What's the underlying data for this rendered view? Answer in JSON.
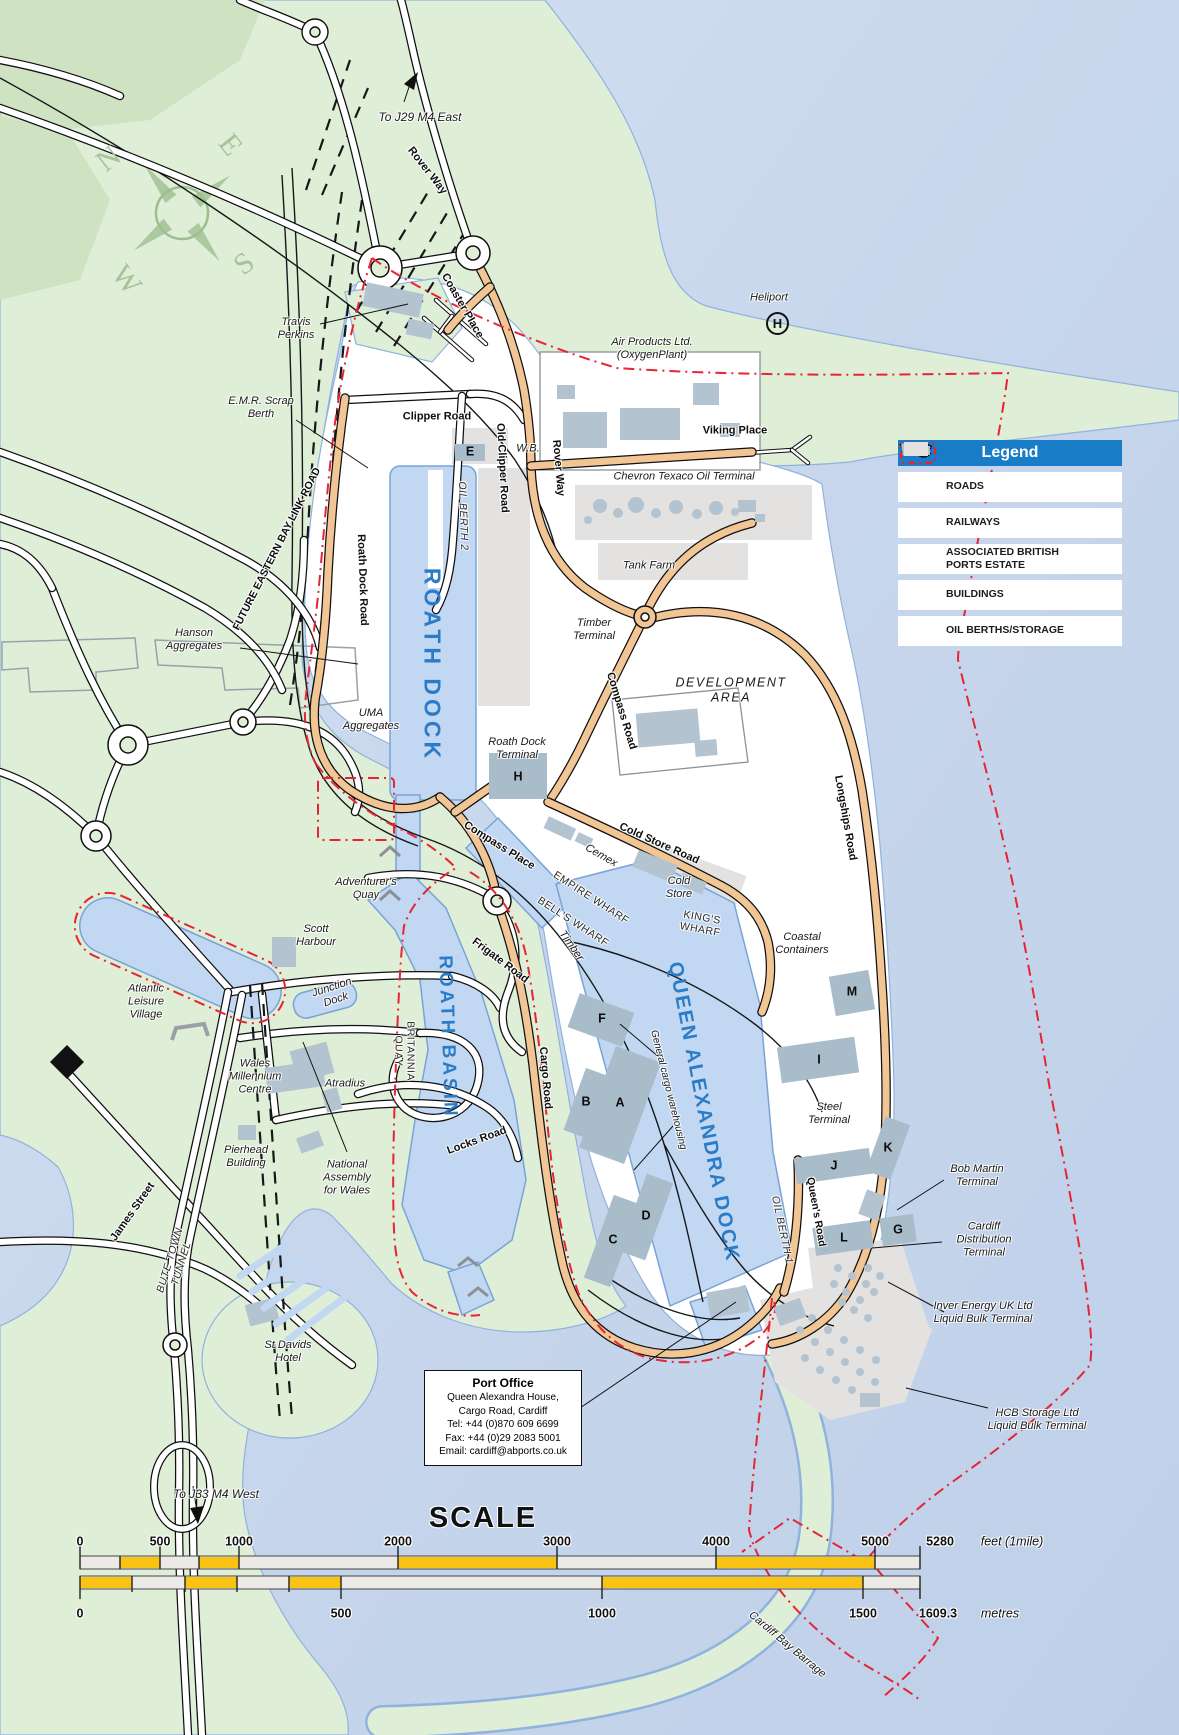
{
  "colors": {
    "water": "#c7d6ec",
    "water_light": "#d6e1f3",
    "land": "#dfeed6",
    "land_dark": "#cfe3c2",
    "port": "#ffffff",
    "dock_fill": "#c2d8f2",
    "dock_stroke": "#79a3d6",
    "road_orange": "#f2c694",
    "building": "#b3c3cf",
    "pad": "#a9bcca",
    "storage": "#e3e2e0",
    "boundary": "#e62433",
    "legend_blue": "#187dc6",
    "scale_yellow": "#f8c313",
    "dock_text": "#2a7cc9"
  },
  "legend": {
    "title": "Legend",
    "items": [
      {
        "label": "ROADS"
      },
      {
        "label": "RAILWAYS"
      },
      {
        "label": "ASSOCIATED BRITISH\nPORTS ESTATE"
      },
      {
        "label": "BUILDINGS"
      },
      {
        "label": "OIL BERTHS/STORAGE"
      }
    ]
  },
  "port_office": {
    "title": "Port Office",
    "lines": [
      "Queen Alexandra House,",
      "Cargo Road, Cardiff",
      "Tel: +44 (0)870 609 6699",
      "Fax: +44 (0)29 2083 5001",
      "Email: cardiff@abports.co.uk"
    ]
  },
  "compass": {
    "n": "N",
    "e": "E",
    "s": "S",
    "w": "W"
  },
  "heliport_symbol": "H",
  "scale": {
    "title": "SCALE",
    "feet": {
      "ticks": [
        "0",
        "500",
        "1000",
        "2000",
        "3000",
        "4000",
        "5000"
      ],
      "end": "5280",
      "unit": "feet (1mile)"
    },
    "metres": {
      "ticks": [
        "0",
        "500",
        "1000",
        "1500"
      ],
      "end": "1609.3",
      "unit": "metres"
    }
  },
  "labels": [
    {
      "t": "To J29 M4 East",
      "x": 420,
      "y": 117,
      "cls": "it",
      "s": 12
    },
    {
      "t": "Rover Way",
      "x": 427,
      "y": 171,
      "r": 52,
      "cls": "rd"
    },
    {
      "t": "Coaster Place",
      "x": 462,
      "y": 306,
      "r": 60,
      "cls": "rd"
    },
    {
      "t": "Travis\nPerkins",
      "x": 296,
      "y": 329,
      "cls": "it"
    },
    {
      "t": "Heliport",
      "x": 769,
      "y": 298,
      "cls": "it"
    },
    {
      "t": "Air Products Ltd.\n(OxygenPlant)",
      "x": 652,
      "y": 349,
      "cls": "it"
    },
    {
      "t": "Viking Place",
      "x": 735,
      "y": 431,
      "cls": "rd"
    },
    {
      "t": "Chevron Texaco Oil Terminal",
      "x": 684,
      "y": 477,
      "cls": "it"
    },
    {
      "t": "W.B.",
      "x": 528,
      "y": 449,
      "cls": "it"
    },
    {
      "t": "Clipper Road",
      "x": 437,
      "y": 417,
      "cls": "rd"
    },
    {
      "t": "Old Clipper Road",
      "x": 502,
      "y": 468,
      "r": 87,
      "cls": "rd"
    },
    {
      "t": "Rover Way",
      "x": 558,
      "y": 468,
      "r": 85,
      "cls": "rd"
    },
    {
      "t": "E.M.R. Scrap\nBerth",
      "x": 261,
      "y": 408,
      "cls": "it"
    },
    {
      "t": "FUTURE EASTERN BAY LINK ROAD",
      "x": 277,
      "y": 549,
      "r": -63,
      "cls": "rd",
      "s": 10.5
    },
    {
      "t": "Roath Dock Road",
      "x": 362,
      "y": 580,
      "r": 88,
      "cls": "rd"
    },
    {
      "t": "OIL BERTH 2",
      "x": 463,
      "y": 516,
      "r": 88,
      "cls": "capit"
    },
    {
      "t": "ROATH DOCK",
      "x": 432,
      "y": 665,
      "r": 90,
      "cls": "dk",
      "s": 23,
      "ls": 4
    },
    {
      "t": "Hanson\nAggregates",
      "x": 194,
      "y": 640,
      "cls": "it"
    },
    {
      "t": "UMA\nAggregates",
      "x": 371,
      "y": 720,
      "cls": "it"
    },
    {
      "t": "Tank Farm",
      "x": 649,
      "y": 566,
      "cls": "it"
    },
    {
      "t": "Timber\nTerminal",
      "x": 594,
      "y": 630,
      "cls": "it"
    },
    {
      "t": "Compass Road",
      "x": 621,
      "y": 711,
      "r": 73,
      "cls": "rd"
    },
    {
      "t": "DEVELOPMENT\nAREA",
      "x": 731,
      "y": 690,
      "cls": "it",
      "s": 12.5,
      "ls": 1.5
    },
    {
      "t": "Roath Dock\nTerminal",
      "x": 517,
      "y": 749,
      "cls": "it"
    },
    {
      "t": "Longships Road",
      "x": 845,
      "y": 818,
      "r": 80,
      "cls": "rd"
    },
    {
      "t": "Compass Place",
      "x": 499,
      "y": 846,
      "r": 32,
      "cls": "rd"
    },
    {
      "t": "Cold Store Road",
      "x": 659,
      "y": 844,
      "r": 24,
      "cls": "rd"
    },
    {
      "t": "Cemex",
      "x": 601,
      "y": 856,
      "r": 30,
      "cls": "it"
    },
    {
      "t": "Cold\nStore",
      "x": 679,
      "y": 888,
      "cls": "it"
    },
    {
      "t": "EMPIRE WHARF",
      "x": 591,
      "y": 898,
      "r": 33,
      "cls": "cap"
    },
    {
      "t": "BELL'S WHARF",
      "x": 573,
      "y": 922,
      "r": 33,
      "cls": "cap"
    },
    {
      "t": "KING'S\nWHARF",
      "x": 701,
      "y": 924,
      "r": 10,
      "cls": "cap"
    },
    {
      "t": "Coastal\nContainers",
      "x": 802,
      "y": 944,
      "cls": "it"
    },
    {
      "t": "Adventurer's\nQuay",
      "x": 366,
      "y": 889,
      "cls": "it"
    },
    {
      "t": "Scott\nHarbour",
      "x": 316,
      "y": 936,
      "cls": "it"
    },
    {
      "t": "Junction\nDock",
      "x": 334,
      "y": 994,
      "r": -18,
      "cls": "it"
    },
    {
      "t": "ROATH BASIN",
      "x": 447,
      "y": 1037,
      "r": 88,
      "cls": "dk",
      "s": 19,
      "ls": 3
    },
    {
      "t": "BRITANNIA\nQUAY",
      "x": 404,
      "y": 1051,
      "r": 90,
      "cls": "cap"
    },
    {
      "t": "Frigate Road",
      "x": 500,
      "y": 961,
      "r": 37,
      "cls": "rd"
    },
    {
      "t": "Timber",
      "x": 571,
      "y": 946,
      "r": 55,
      "cls": "it"
    },
    {
      "t": "Cargo Road",
      "x": 545,
      "y": 1078,
      "r": 85,
      "cls": "rd"
    },
    {
      "t": "Locks Road",
      "x": 477,
      "y": 1141,
      "r": -20,
      "cls": "rd"
    },
    {
      "t": "Atradius",
      "x": 345,
      "y": 1084,
      "cls": "it"
    },
    {
      "t": "Atlantic\nLeisure\nVillage",
      "x": 146,
      "y": 1002,
      "cls": "it"
    },
    {
      "t": "Wales\nMillennium\nCentre",
      "x": 255,
      "y": 1077,
      "cls": "it"
    },
    {
      "t": "Pierhead\nBuilding",
      "x": 246,
      "y": 1157,
      "cls": "it"
    },
    {
      "t": "National\nAssembly\nfor Wales",
      "x": 347,
      "y": 1178,
      "cls": "it"
    },
    {
      "t": "James Street",
      "x": 133,
      "y": 1212,
      "r": -55,
      "cls": "rd"
    },
    {
      "t": "BUTE TOWN\nTUNNEL",
      "x": 176,
      "y": 1262,
      "r": -73,
      "cls": "capit"
    },
    {
      "t": "St Davids\nHotel",
      "x": 288,
      "y": 1352,
      "cls": "it"
    },
    {
      "t": "To J33 M4 West",
      "x": 216,
      "y": 1494,
      "cls": "it",
      "s": 12
    },
    {
      "t": "QUEEN ALEXANDRA DOCK",
      "x": 703,
      "y": 1112,
      "r": 79,
      "cls": "dk",
      "s": 20,
      "ls": 2
    },
    {
      "t": "General cargo warehousing",
      "x": 668,
      "y": 1090,
      "r": 76,
      "cls": "it",
      "s": 10
    },
    {
      "t": "OIL BERTH 1",
      "x": 782,
      "y": 1230,
      "r": 78,
      "cls": "capit"
    },
    {
      "t": "Queen's Road",
      "x": 816,
      "y": 1212,
      "r": 80,
      "cls": "rd",
      "s": 10.5
    },
    {
      "t": "Steel\nTerminal",
      "x": 829,
      "y": 1114,
      "cls": "it"
    },
    {
      "t": "Bob Martin\nTerminal",
      "x": 977,
      "y": 1176,
      "cls": "it"
    },
    {
      "t": "Cardiff\nDistribution\nTerminal",
      "x": 984,
      "y": 1240,
      "cls": "it"
    },
    {
      "t": "Inver Energy UK Ltd\nLiquid Bulk Terminal",
      "x": 983,
      "y": 1313,
      "cls": "it"
    },
    {
      "t": "HCB Storage Ltd\nLiquid Bulk Terminal",
      "x": 1037,
      "y": 1420,
      "cls": "it"
    },
    {
      "t": "Cardiff Bay Barrage",
      "x": 787,
      "y": 1645,
      "r": 40,
      "cls": "it"
    },
    {
      "t": "E",
      "x": 470,
      "y": 452,
      "cls": "mk",
      "n": "marker-e"
    },
    {
      "t": "H",
      "x": 518,
      "y": 777,
      "cls": "mk",
      "n": "marker-h"
    },
    {
      "t": "F",
      "x": 602,
      "y": 1019,
      "cls": "mk",
      "n": "marker-f"
    },
    {
      "t": "B",
      "x": 586,
      "y": 1102,
      "cls": "mk",
      "n": "marker-b"
    },
    {
      "t": "A",
      "x": 620,
      "y": 1103,
      "cls": "mk",
      "n": "marker-a"
    },
    {
      "t": "D",
      "x": 646,
      "y": 1216,
      "cls": "mk",
      "n": "marker-d"
    },
    {
      "t": "C",
      "x": 613,
      "y": 1240,
      "cls": "mk",
      "n": "marker-c"
    },
    {
      "t": "M",
      "x": 852,
      "y": 992,
      "cls": "mk",
      "n": "marker-m"
    },
    {
      "t": "I",
      "x": 819,
      "y": 1060,
      "cls": "mk",
      "n": "marker-i"
    },
    {
      "t": "K",
      "x": 888,
      "y": 1148,
      "cls": "mk",
      "n": "marker-k"
    },
    {
      "t": "J",
      "x": 834,
      "y": 1166,
      "cls": "mk",
      "n": "marker-j"
    },
    {
      "t": "L",
      "x": 844,
      "y": 1238,
      "cls": "mk",
      "n": "marker-l"
    },
    {
      "t": "G",
      "x": 898,
      "y": 1230,
      "cls": "mk",
      "n": "marker-g"
    }
  ]
}
